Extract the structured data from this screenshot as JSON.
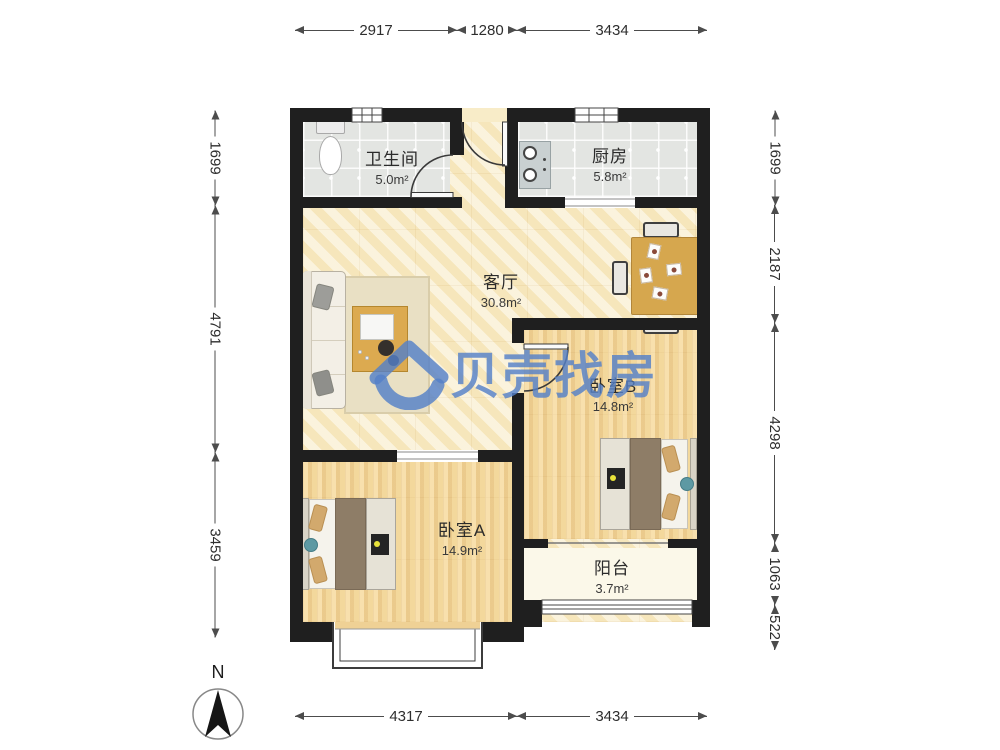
{
  "plan": {
    "type": "apartment-floor-plan",
    "wall_color": "#1f1f1f",
    "accent_watermark_color": "#5480c8"
  },
  "watermark": {
    "logo": "beike-house-logo",
    "text": "贝壳找房"
  },
  "compass": {
    "label": "N"
  },
  "rooms": [
    {
      "id": "bathroom",
      "name": "卫生间",
      "area": "5.0m²"
    },
    {
      "id": "kitchen",
      "name": "厨房",
      "area": "5.8m²"
    },
    {
      "id": "living",
      "name": "客厅",
      "area": "30.8m²"
    },
    {
      "id": "bedroom_b",
      "name": "卧室B",
      "area": "14.8m²"
    },
    {
      "id": "bedroom_a",
      "name": "卧室A",
      "area": "14.9m²"
    },
    {
      "id": "balcony",
      "name": "阳台",
      "area": "3.7m²"
    }
  ],
  "dimensions_mm": {
    "top": [
      "2917",
      "1280",
      "3434"
    ],
    "bottom": [
      "4317",
      "3434"
    ],
    "left": [
      "1699",
      "4791",
      "3459"
    ],
    "right": [
      "1699",
      "2187",
      "4298",
      "1063",
      "522"
    ]
  }
}
